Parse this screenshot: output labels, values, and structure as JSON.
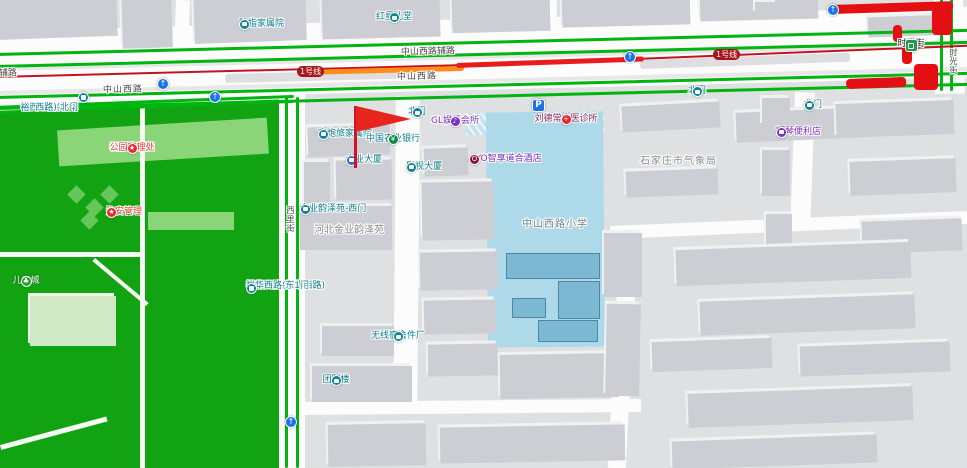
{
  "roads": {
    "zhongshan_west": "中山西路",
    "zhongshan_west_service": "中山西路辅路",
    "xilijie": "西里街",
    "shiguangjie_street": "时光街"
  },
  "transit": {
    "line1_badge": "1号线",
    "station_shiguangjie": "时光街",
    "parking": "P"
  },
  "pois": {
    "luzhi_compound": "陆指家属院",
    "hongxing_hall": "红星礼堂",
    "park_north_gate": {
      "line1": "裕西公园(裕华",
      "line2": "西路)-北门"
    },
    "park_office": {
      "line1": "石家庄裕西",
      "line2": "公园管理处"
    },
    "security_mgmt": "治安管理",
    "children_city": "儿童城",
    "gaopaolv_compound": "高炮旅家属院",
    "jinye_tower": "金业大厦",
    "jinye_west_gate": "金业韵泽苑-西门",
    "hebei_jinye_garden": "河北金业韵泽苑",
    "north_gate": "北门",
    "gl_club": "GL娱乐会所",
    "abc_bank": "中国农业银行",
    "yingshi_tower": "影视大厦",
    "oyo_hotel": "OYO智享道合酒店",
    "liudechang_clinic": "刘德常中医诊所",
    "weather_bureau": "石家庄市气象局",
    "zhongshan_school": "中山西路小学",
    "radio_factory_dorm": {
      "line1": "无线电元件厂",
      "line2": "宿舍"
    },
    "tuanzhi_building": "团职楼",
    "park_east_gate": {
      "line1": "裕西公园(裕华西路)",
      "line2": "裕华西路-东1门"
    },
    "yaoqin_store": "耀琴便利店"
  },
  "icons": {
    "star_glyph": "★",
    "music_glyph": "♪",
    "arrow_glyph": "↑",
    "tree_glyph": "♣",
    "bank_glyph": "¥",
    "plus_glyph": "+",
    "hotel_glyph": "O"
  },
  "colors": {
    "park_green": "#12a312",
    "traffic_smooth_green": "#00b50f",
    "traffic_slow_orange": "#ff8d1a",
    "traffic_jam_red": "#e81c1c",
    "metro_line_red": "#c41320",
    "school_blue": "#aed9e9",
    "poi_teal": "#0b7d8d",
    "poi_purple": "#7c2dc2",
    "poi_red": "#e8403a",
    "flag_red": "#e8251d"
  }
}
